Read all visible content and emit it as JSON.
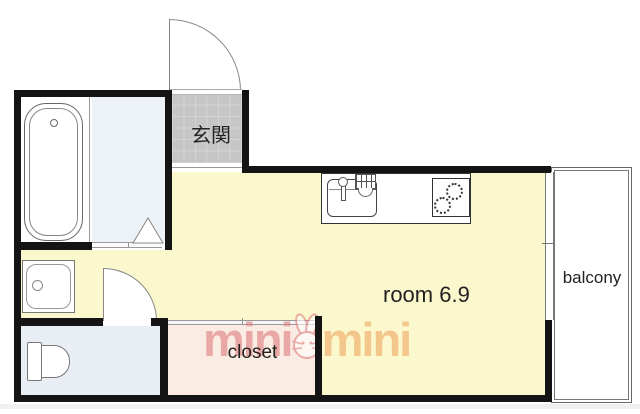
{
  "plan_type": "apartment-floor-plan",
  "rooms": {
    "entrance_label": "玄関",
    "main_room_label": "room 6.9",
    "balcony_label": "balcony",
    "closet_label": "closet"
  },
  "watermark": {
    "left": "mini",
    "right": "mini",
    "mascot": "rabbit"
  },
  "fixtures": {
    "bathtub": "bathtub",
    "washing_machine_pan": "washing-machine-pan",
    "toilet": "toilet",
    "kitchen_sink": "kitchen-sink-with-faucet",
    "stove": "two-burner-stove",
    "entrance_door": "swing-door",
    "toilet_door": "swing-door",
    "washroom_door": "folding-door",
    "window": "sliding-window",
    "closet_door": "sliding-door"
  },
  "colors": {
    "wall": "#141414",
    "floor_room": "#fbf8cd",
    "floor_entrance": "#c6c6c6",
    "floor_washroom": "#edf1f8",
    "floor_toilet": "#e9edf4",
    "floor_closet": "#faece3",
    "wm_pink": "#e08080",
    "wm_orange": "#f2b879",
    "balcony_line": "#666666"
  }
}
